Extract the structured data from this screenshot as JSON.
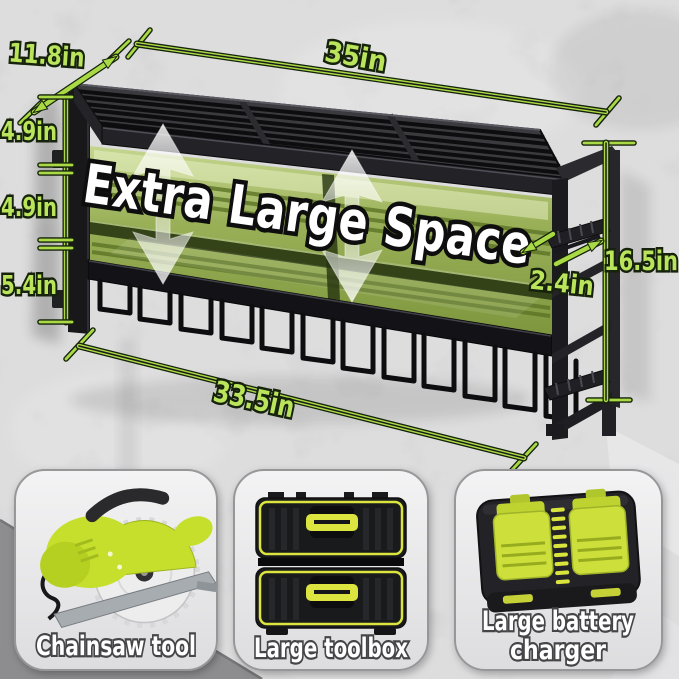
{
  "scene": {
    "type": "product-dimension-diagram",
    "overlay_text": "Extra Large Space",
    "colors": {
      "label-green": "#b9e45b",
      "line-green": "#a9da45",
      "line-dark": "#16220b",
      "rack-black": "#1d1d20",
      "interior-green-light": "#cfe39b",
      "interior-green-dark": "#7e9b33",
      "accent-yellow": "#dce43f",
      "saw-green": "#c6df2d",
      "wall-gray": "#c7c7c9",
      "card-gray": "#ededee"
    }
  },
  "dimensions": {
    "top_depth": {
      "label": "11.8in"
    },
    "top_width": {
      "label": "35in"
    },
    "left_sections": [
      {
        "label": "4.9in"
      },
      {
        "label": "4.9in"
      },
      {
        "label": "5.4in"
      }
    ],
    "right_height": {
      "label": "16.5in"
    },
    "bracket_depth": {
      "label": "2.4in"
    },
    "bottom_width": {
      "label": "33.5in"
    }
  },
  "cards": [
    {
      "icon": "circular-saw-image",
      "lines": [
        "Chainsaw tool"
      ]
    },
    {
      "icon": "two-drawer-toolbox-image",
      "lines": [
        "Large toolbox"
      ]
    },
    {
      "icon": "dual-battery-charger-image",
      "lines": [
        "Large battery",
        "charger"
      ]
    }
  ]
}
